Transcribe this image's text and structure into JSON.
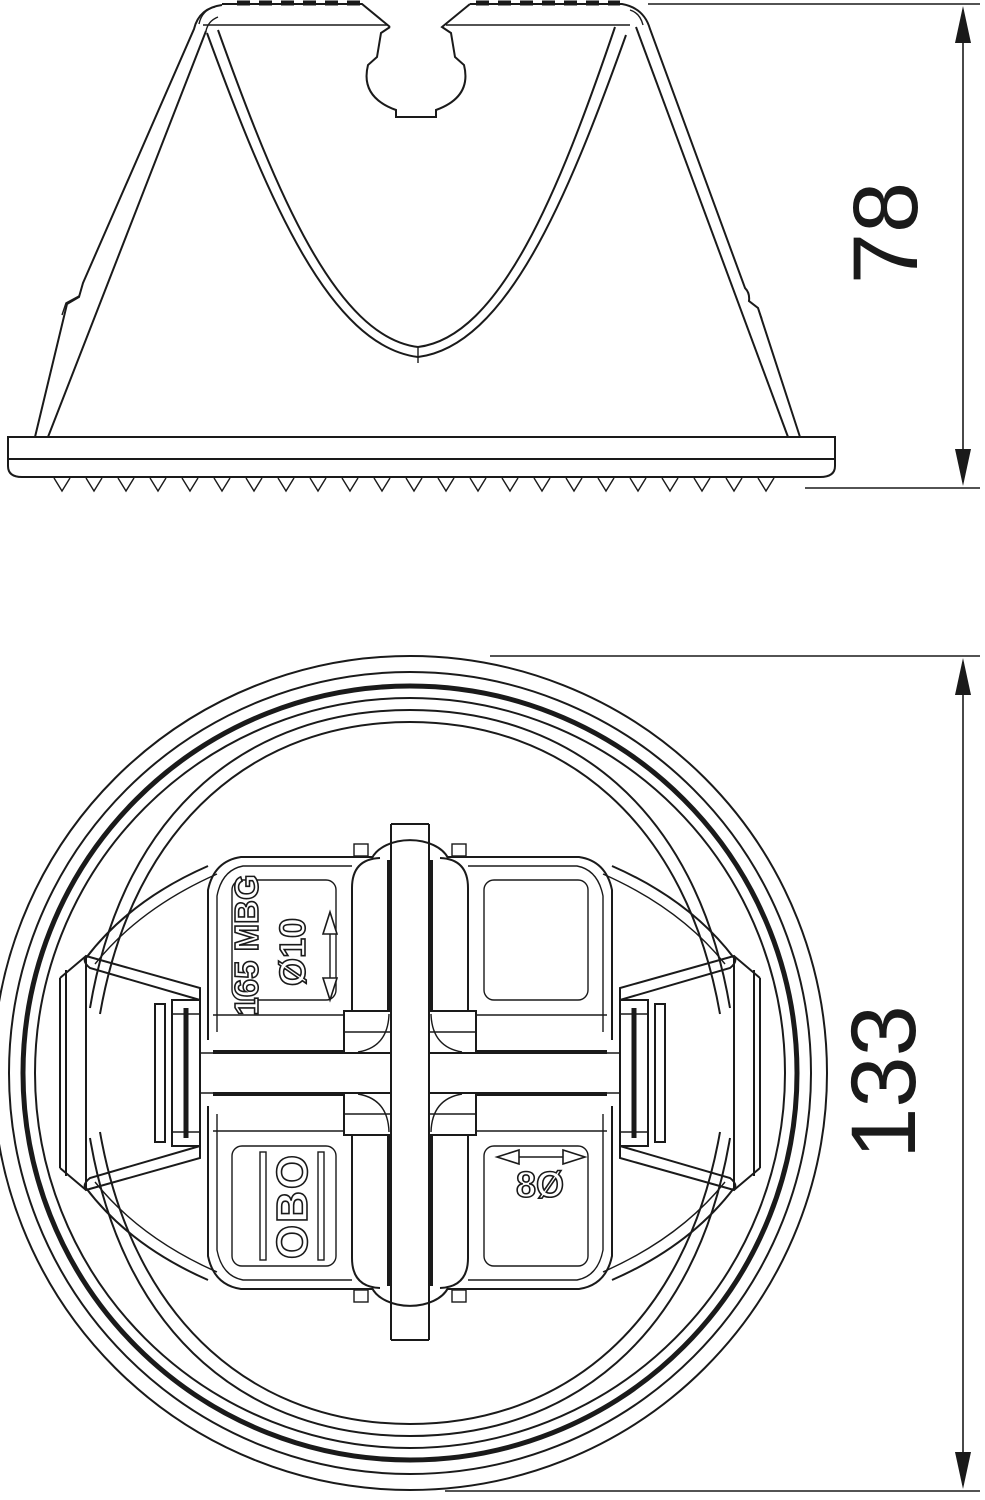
{
  "drawing": {
    "dimensions": {
      "side_view_height": "78",
      "bottom_view_diameter": "133"
    },
    "markings": {
      "type_label": "165 MBG",
      "top_conductor_dia": "Ø10",
      "brand": "OBO",
      "bottom_conductor_dia": "8Ø"
    },
    "colors": {
      "line": "#1a1a1a",
      "background": "#ffffff"
    }
  }
}
